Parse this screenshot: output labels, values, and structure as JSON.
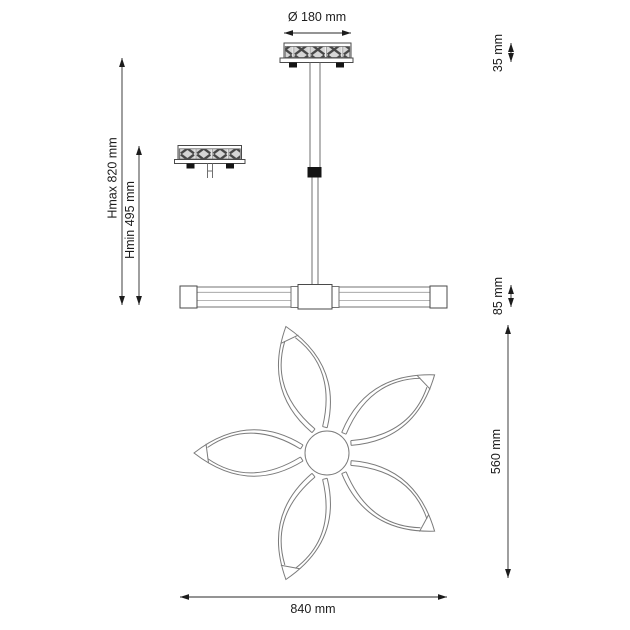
{
  "drawing": {
    "type": "pendant-lamp-dimension-diagram",
    "background_color": "#ffffff",
    "line_color": "#2a2a2a",
    "pattern_fill_color": "#d6d6d6",
    "dim_labels": {
      "canopy_diameter": "Ø 180 mm",
      "canopy_height": "35 mm",
      "height_max": "Hmax 820 mm",
      "height_min": "Hmin 495 mm",
      "bar_height": "85 mm",
      "shade_span": "560 mm",
      "fixture_width": "840 mm"
    }
  }
}
